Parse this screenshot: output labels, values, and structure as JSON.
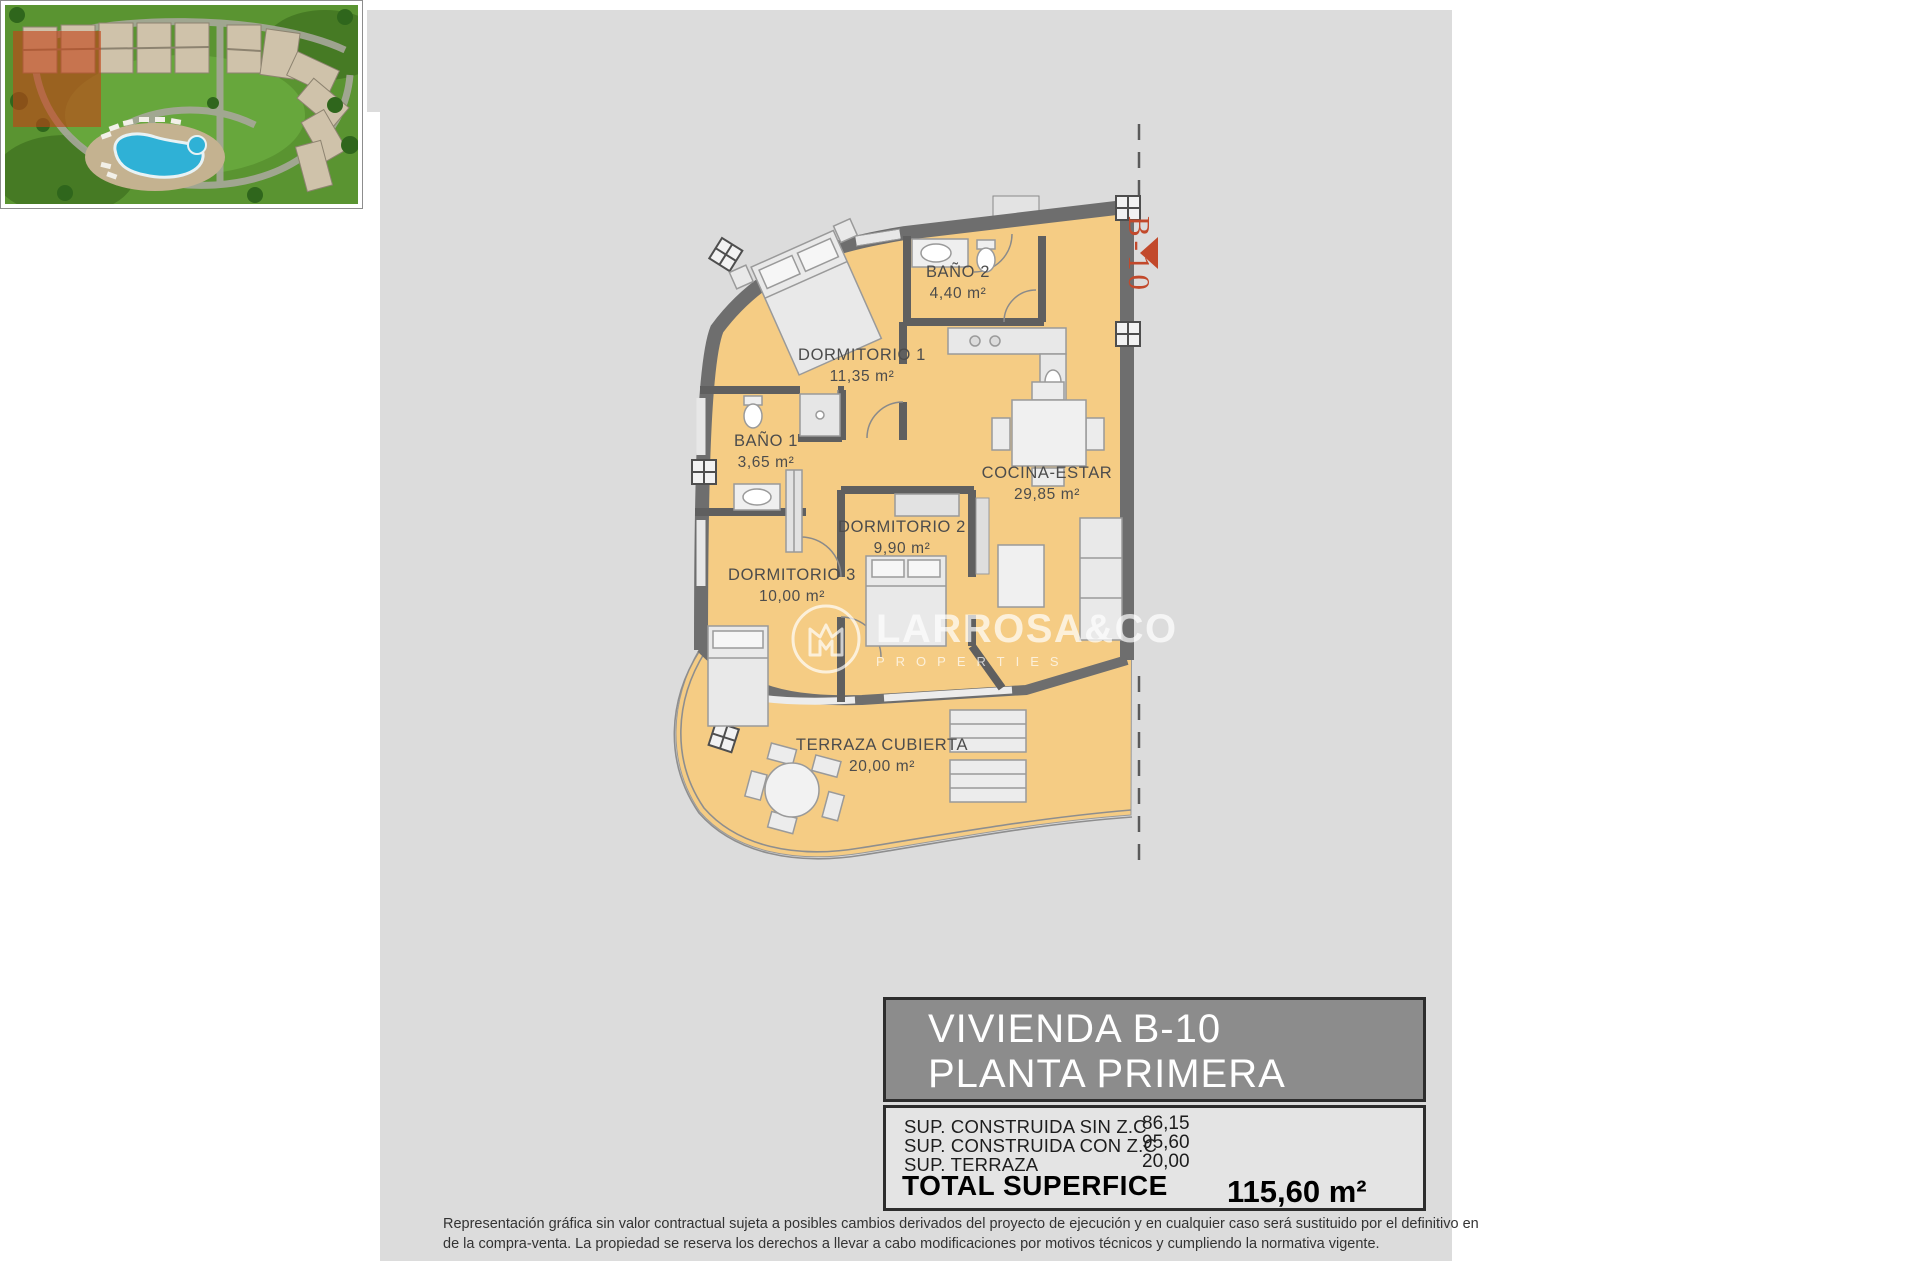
{
  "plan": {
    "unit_label": "B-10",
    "rooms": [
      {
        "name": "BAÑO 2",
        "area": "4,40 m²"
      },
      {
        "name": "DORMITORIO 1",
        "area": "11,35 m²"
      },
      {
        "name": "BAÑO 1",
        "area": "3,65 m²"
      },
      {
        "name": "COCINA-ESTAR",
        "area": "29,85 m²"
      },
      {
        "name": "DORMITORIO 2",
        "area": "9,90 m²"
      },
      {
        "name": "DORMITORIO 3",
        "area": "10,00 m²"
      },
      {
        "name": "TERRAZA CUBIERTA",
        "area": "20,00 m²"
      }
    ],
    "colors": {
      "floor": "#f5cc84",
      "wall": "#6e6e6e",
      "accent_red": "#c2492b",
      "sheet_bg": "#dcdcdc"
    }
  },
  "watermark": {
    "brand": "LARROSA&CO",
    "subtitle": "PROPERTIES"
  },
  "info_panel": {
    "title_line1": "VIVIENDA B-10",
    "title_line2": "PLANTA PRIMERA",
    "rows": [
      {
        "label": "SUP. CONSTRUIDA SIN Z.C",
        "value": "86,15"
      },
      {
        "label": "SUP. CONSTRUIDA CON Z.C",
        "value": "95,60"
      },
      {
        "label": "SUP. TERRAZA",
        "value": "20,00"
      }
    ],
    "total_label": "TOTAL SUPERFICE",
    "total_value": "115,60 m²"
  },
  "disclaimer": {
    "line1": "Representación gráfica sin valor contractual sujeta a posibles cambios derivados del proyecto de ejecución y en cualquier caso será sustituido por el definitivo en",
    "line2": "de la compra-venta. La propiedad se reserva los derechos a llevar a cabo modificaciones por motivos técnicos y cumpliendo la normativa vigente."
  }
}
